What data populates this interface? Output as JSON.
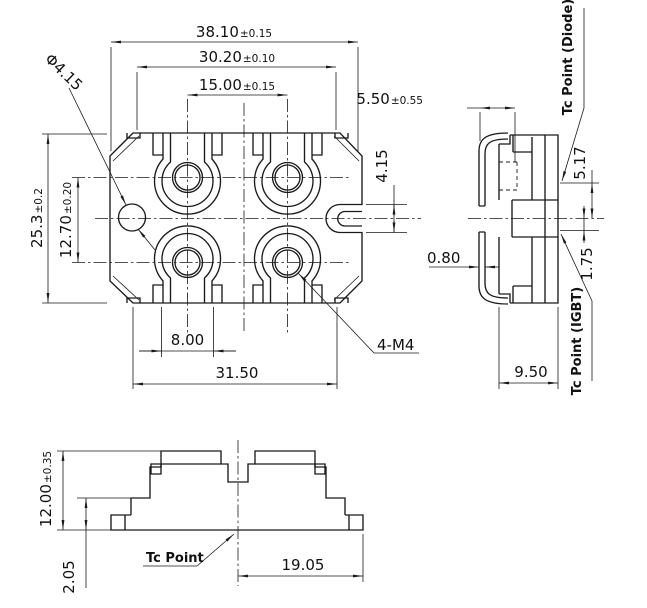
{
  "colors": {
    "line": "#1a1a1a",
    "background": "#ffffff"
  },
  "top_view": {
    "dims": {
      "overall_width": {
        "value": "38.10",
        "tol": "±0.15"
      },
      "inner_width": {
        "value": "30.20",
        "tol": "±0.10"
      },
      "terminal_pitch_x": {
        "value": "15.00",
        "tol": "±0.15"
      },
      "mount_hole_dia": {
        "value": "Φ4.15",
        "tol": ""
      },
      "overall_depth": {
        "value": "25.3",
        "tol": "±0.2"
      },
      "terminal_pitch_y": {
        "value": "12.70",
        "tol": "±0.20"
      },
      "pad_width": {
        "value": "8.00",
        "tol": ""
      },
      "flange_span": {
        "value": "31.50",
        "tol": ""
      },
      "thread_callout": {
        "value": "4-M4",
        "tol": ""
      },
      "side_tab": {
        "value": "4.15",
        "tol": ""
      }
    }
  },
  "side_view": {
    "dims": {
      "lead_offset": {
        "value": "5.50",
        "tol": "±0.55"
      },
      "lead_thickness": {
        "value": "0.80",
        "tol": ""
      },
      "body_thickness": {
        "value": "9.50",
        "tol": ""
      },
      "tc_diode_offset": {
        "value": "5.17",
        "tol": ""
      },
      "tc_igbt_offset": {
        "value": "1.75",
        "tol": ""
      }
    },
    "labels": {
      "tc_diode": "Tc Point (Diode)",
      "tc_igbt": "Tc Point (IGBT)"
    }
  },
  "front_view": {
    "dims": {
      "overall_height": {
        "value": "12.00",
        "tol": "±0.35"
      },
      "base_height": {
        "value": "2.05",
        "tol": ""
      },
      "center_to_edge": {
        "value": "19.05",
        "tol": ""
      }
    },
    "labels": {
      "tc_point": "Tc Point"
    }
  }
}
